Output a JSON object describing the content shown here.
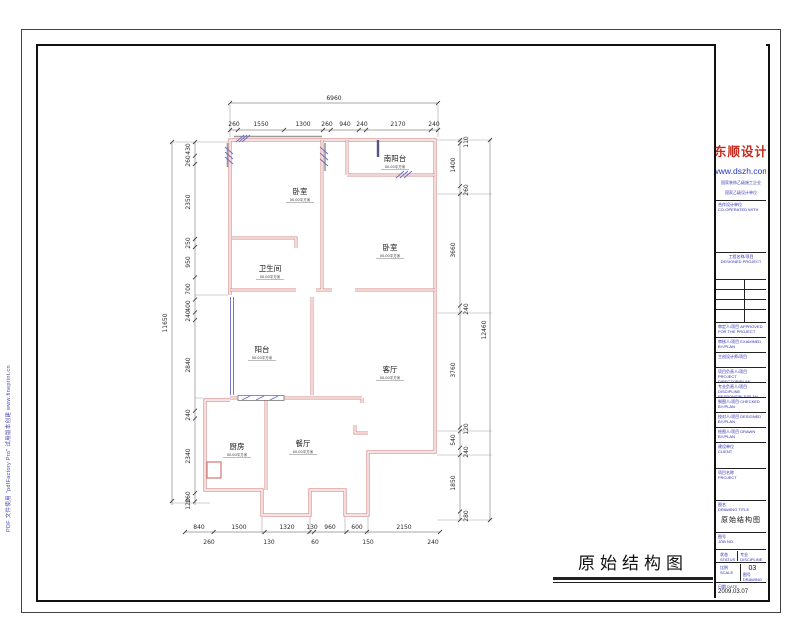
{
  "sheet": {
    "watermark": "PDF 文件使用 \"pdfFactory Pro\" 试用版本创建            www.fineprint.cn",
    "drawing_title": "原始结构图"
  },
  "plan": {
    "rooms": [
      {
        "name": "卧室",
        "note": "00.00平方米"
      },
      {
        "name": "南阳台",
        "note": "00.00平方米"
      },
      {
        "name": "卧室",
        "note": "00.00平方米"
      },
      {
        "name": "卫生间",
        "note": "00.00平方米"
      },
      {
        "name": "阳台",
        "note": "00.00平方米"
      },
      {
        "name": "客厅",
        "note": "00.00平方米"
      },
      {
        "name": "厨房",
        "note": "00.00平方米"
      },
      {
        "name": "餐厅",
        "note": "00.00平方米"
      }
    ],
    "dims": {
      "top_total": "6960",
      "top": [
        "260",
        "1550",
        "1300",
        "260",
        "940",
        "240",
        "2170",
        "240"
      ],
      "left_total": "11650",
      "left": [
        "430",
        "260",
        "2350",
        "250",
        "950",
        "700",
        "400",
        "240",
        "2840",
        "240",
        "2340",
        "260",
        "120"
      ],
      "right_total": "12460",
      "right_rooms": [
        "1400",
        "3660",
        "3760",
        "540",
        "1850"
      ],
      "right_walls": [
        "110",
        "260",
        "240",
        "120",
        "240",
        "280"
      ],
      "bottom_a": [
        "840",
        "1500",
        "1320",
        "130",
        "960",
        "600",
        "2150"
      ],
      "bottom_b": [
        "260",
        "130",
        "60",
        "150",
        "240"
      ]
    }
  },
  "titleblock": {
    "brand": "东顺设计",
    "url": "www.dszh.com",
    "cert1": "国家装饰乙级施工企业",
    "cert2": "国家乙级设计单位",
    "rows": [
      {
        "cn": "合作设计单位",
        "en": "CO-OPERATED WITH"
      },
      {
        "cn": "工程名称/项目",
        "en": "DESIGNED PROJECT"
      },
      {
        "cn": "审定人/项目",
        "en": "APPROVED FOR THE PROJECT"
      },
      {
        "cn": "审核人/项目",
        "en": "EXAMINED BY/PLAN"
      },
      {
        "cn": "主创设计师/项目",
        "en": ""
      },
      {
        "cn": "项目负责人/项目",
        "en": "PROJECT DIRECTOR/PLAN"
      },
      {
        "cn": "专业负责人/项目",
        "en": "DISCIPLINE RESPONSIBLE/PLAN"
      },
      {
        "cn": "制图人/项目",
        "en": "CHECKED BY/PLAN"
      },
      {
        "cn": "校对人/项目",
        "en": "DESIGNED BY/PLAN"
      },
      {
        "cn": "绘图人/项目",
        "en": "DRAWN BY/PLAN"
      },
      {
        "cn": "建设单位",
        "en": "CLIENT"
      },
      {
        "cn": "项目名称",
        "en": "PROJECT"
      },
      {
        "cn": "图名",
        "en": "DRAWING TITLE"
      },
      {
        "cn": "图号",
        "en": "JOB NO."
      }
    ],
    "footer": {
      "status_cn": "状态",
      "status_en": "STATUS",
      "discipline_cn": "专业",
      "discipline_en": "DISCIPLINE",
      "scale_cn": "比例",
      "scale_en": "SCALE",
      "scale": "1:80",
      "no_cn": "图号",
      "no_en": "DRAWING NO.",
      "no": "03",
      "date_cn": "日期",
      "date_en": "DATE",
      "date": "2009.03.07"
    }
  }
}
